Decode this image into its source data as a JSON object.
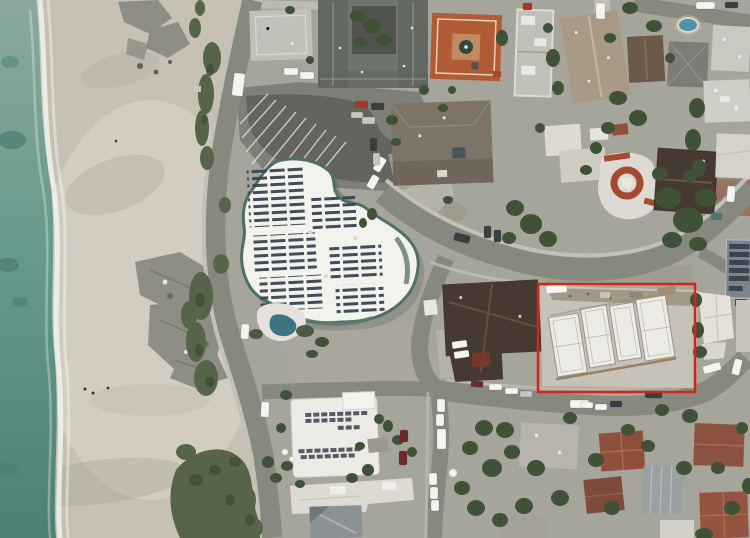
{
  "meta": {
    "title": "Aerial photo of coastal neighborhood with highlighted construction site",
    "description": "Drone aerial view: ocean and sandy beach on the left, a large white resort building with rooftop solar arrays at center, curving streets with parked cars, surrounding houses, and a red rectangle annotation highlighting a white building complex under construction.",
    "width": 750,
    "height": 538
  },
  "annotation": {
    "name": "highlight-box",
    "shape": "rectangle",
    "x": 538,
    "y": 284,
    "width": 157,
    "height": 108,
    "stroke_width": 2.5,
    "color": "#d2261c"
  },
  "palette": {
    "ocean_top": "#8ba89d",
    "ocean": "#679b8d",
    "ocean_deep": "#4d8173",
    "foam": "#eef3ec",
    "sand": "#c7c0b3",
    "sand_bright": "#dcd6ca",
    "sand_shadow": "#a29d92",
    "rock": "#8f8e86",
    "rock_dark": "#62625b",
    "bluff": "#56644a",
    "tree": "#3f5137",
    "ground": "#a6a59b",
    "dirt": "#8c7c66",
    "road": "#87897f",
    "road_dark": "#5d5f58",
    "plaza": "#7d7f78",
    "sidewalk": "#c3c1b7",
    "stripe": "#ebeae4",
    "resort_roof": "#f3f3ee",
    "resort_trim": "#4e7064",
    "solar": "#3a4351",
    "pool": "#3b7582",
    "roof_gray": "#6f746f",
    "roof_gray_dark": "#5f645e",
    "roof_light": "#c0bfb8",
    "roof_tan": "#a89a86",
    "roof_brown": "#7d7366",
    "roof_darkbrown": "#453931",
    "roof_red": "#b15c35",
    "roof_terracotta": "#8e4f3b",
    "roof_white": "#dcdad2",
    "roof_metal": "#9aa0a2",
    "construction_pad": "#c6c2b8",
    "construction_white": "#edebe5",
    "brick": "#98695a",
    "car_white": "#f4f4f0",
    "car_silver": "#c6c6c2",
    "car_dark": "#3b3e41",
    "car_red": "#b03428",
    "car_maroon": "#6c2a28"
  },
  "scene": {
    "regions": [
      "ocean",
      "surf-foam",
      "beach-sand",
      "beach-rocks",
      "coastal-bluff",
      "coast-road",
      "parking-plaza",
      "main-road",
      "lower-street",
      "resort-building",
      "resort-solar-arrays",
      "resort-pool",
      "neighborhood-houses",
      "construction-site",
      "trees",
      "parked-cars",
      "annotation-rectangle"
    ]
  }
}
